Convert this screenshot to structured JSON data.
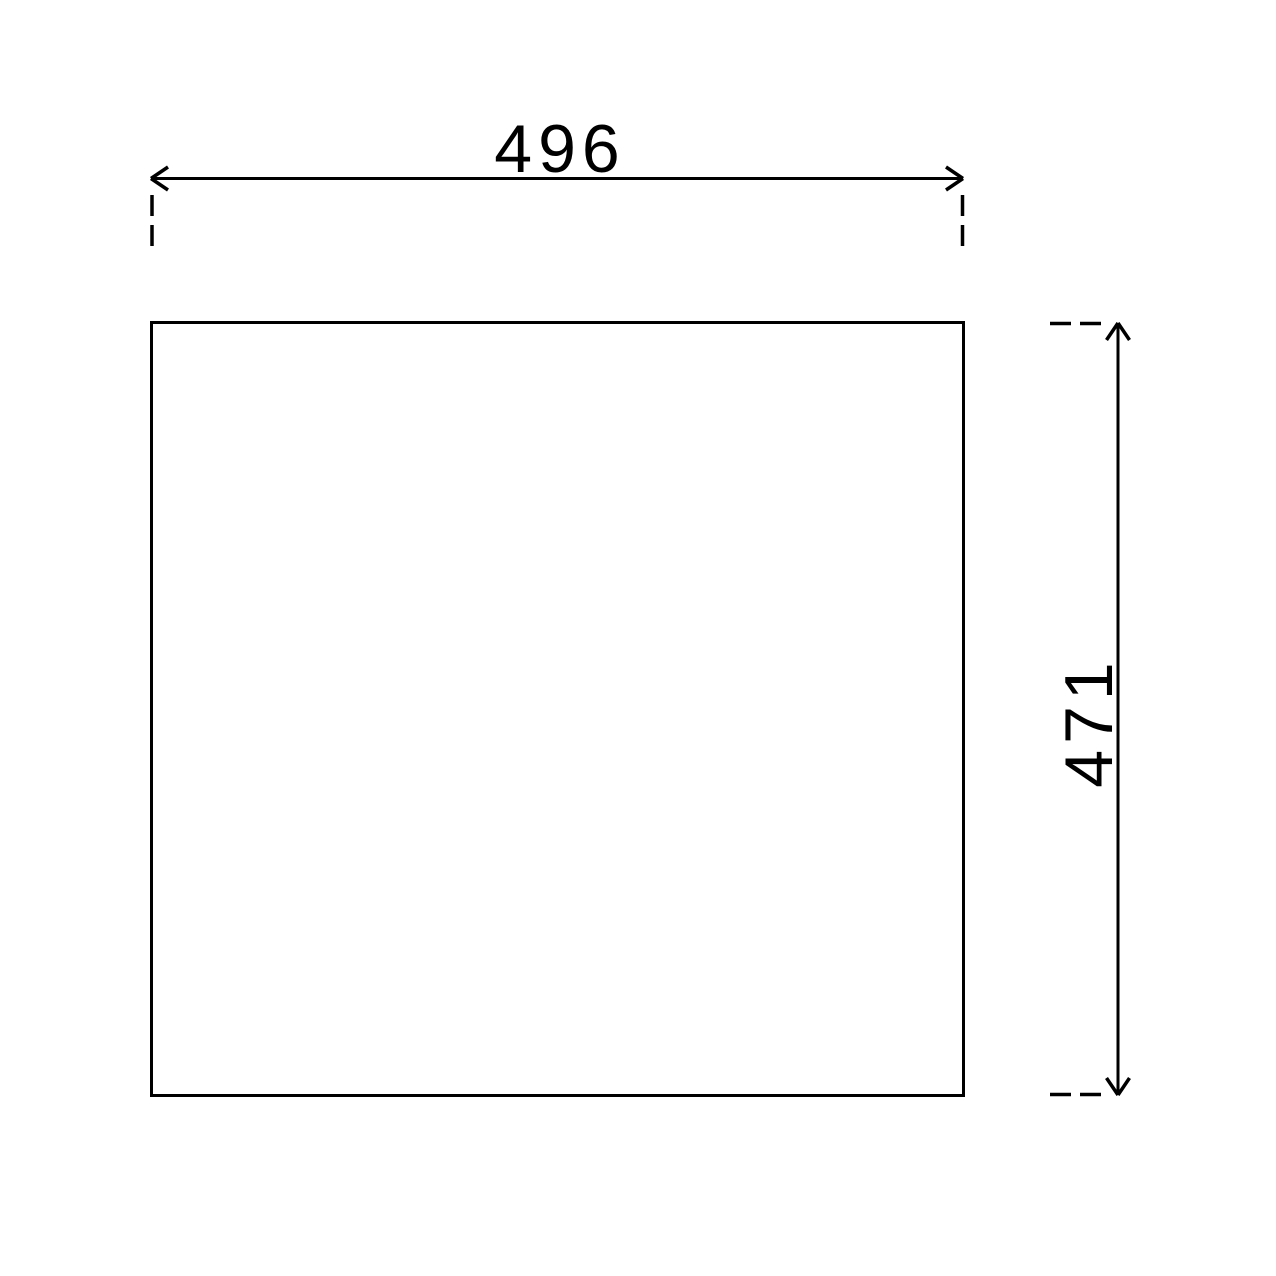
{
  "page": {
    "background_color": "#ffffff",
    "line_color": "#000000"
  },
  "drawing": {
    "type": "technical-dimension-drawing",
    "shape": "rectangle",
    "dimensions": {
      "width": {
        "value": "496",
        "orientation": "horizontal",
        "position": "top"
      },
      "height": {
        "value": "471",
        "orientation": "vertical",
        "position": "right"
      }
    }
  }
}
